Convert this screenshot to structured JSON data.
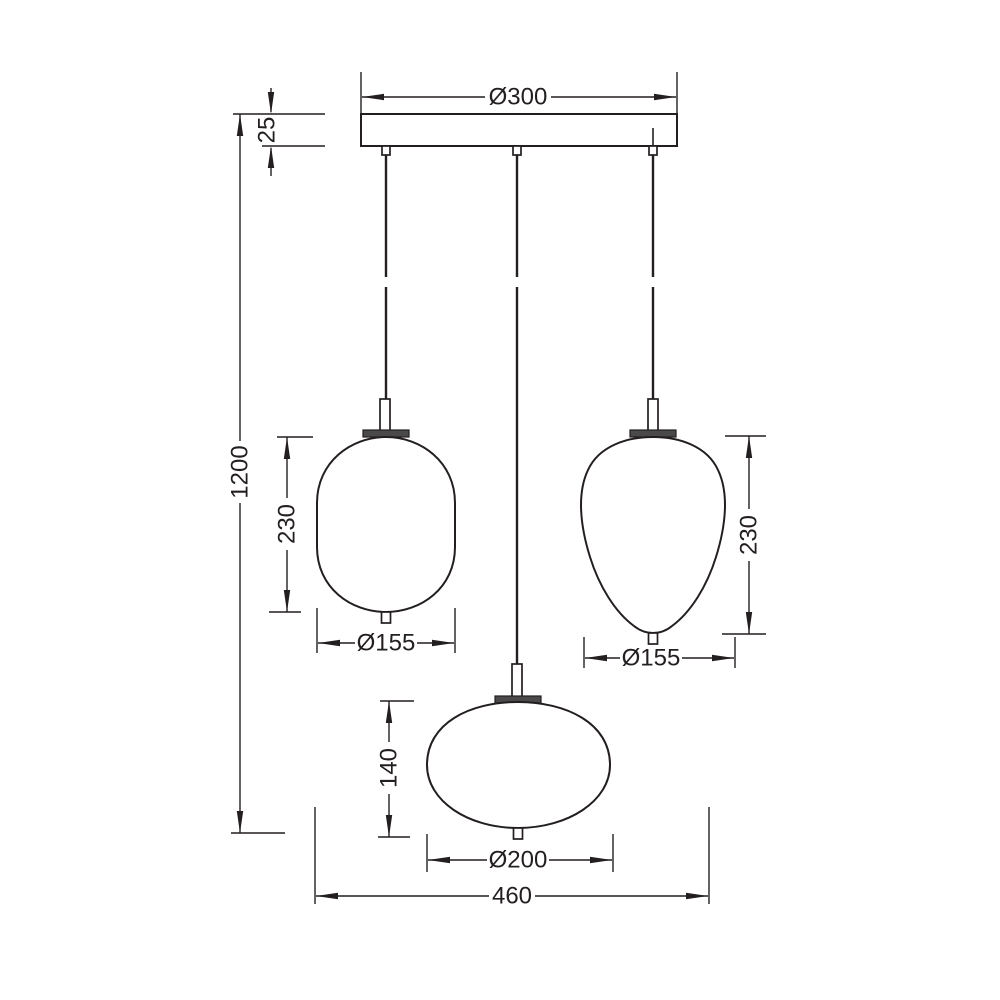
{
  "drawing": {
    "subject": "three-light-pendant-lamp-dimension-drawing",
    "colors": {
      "line": "#231f20",
      "background": "#ffffff",
      "collar_fill": "#4a4a4a"
    },
    "dims": {
      "canopy_diameter": "Ø300",
      "canopy_height": "25",
      "suspension_height": "1200",
      "left_shade_height": "230",
      "left_shade_diameter": "Ø155",
      "right_shade_height": "230",
      "right_shade_diameter": "Ø155",
      "center_shade_height": "140",
      "center_shade_diameter": "Ø200",
      "overall_width": "460"
    }
  }
}
